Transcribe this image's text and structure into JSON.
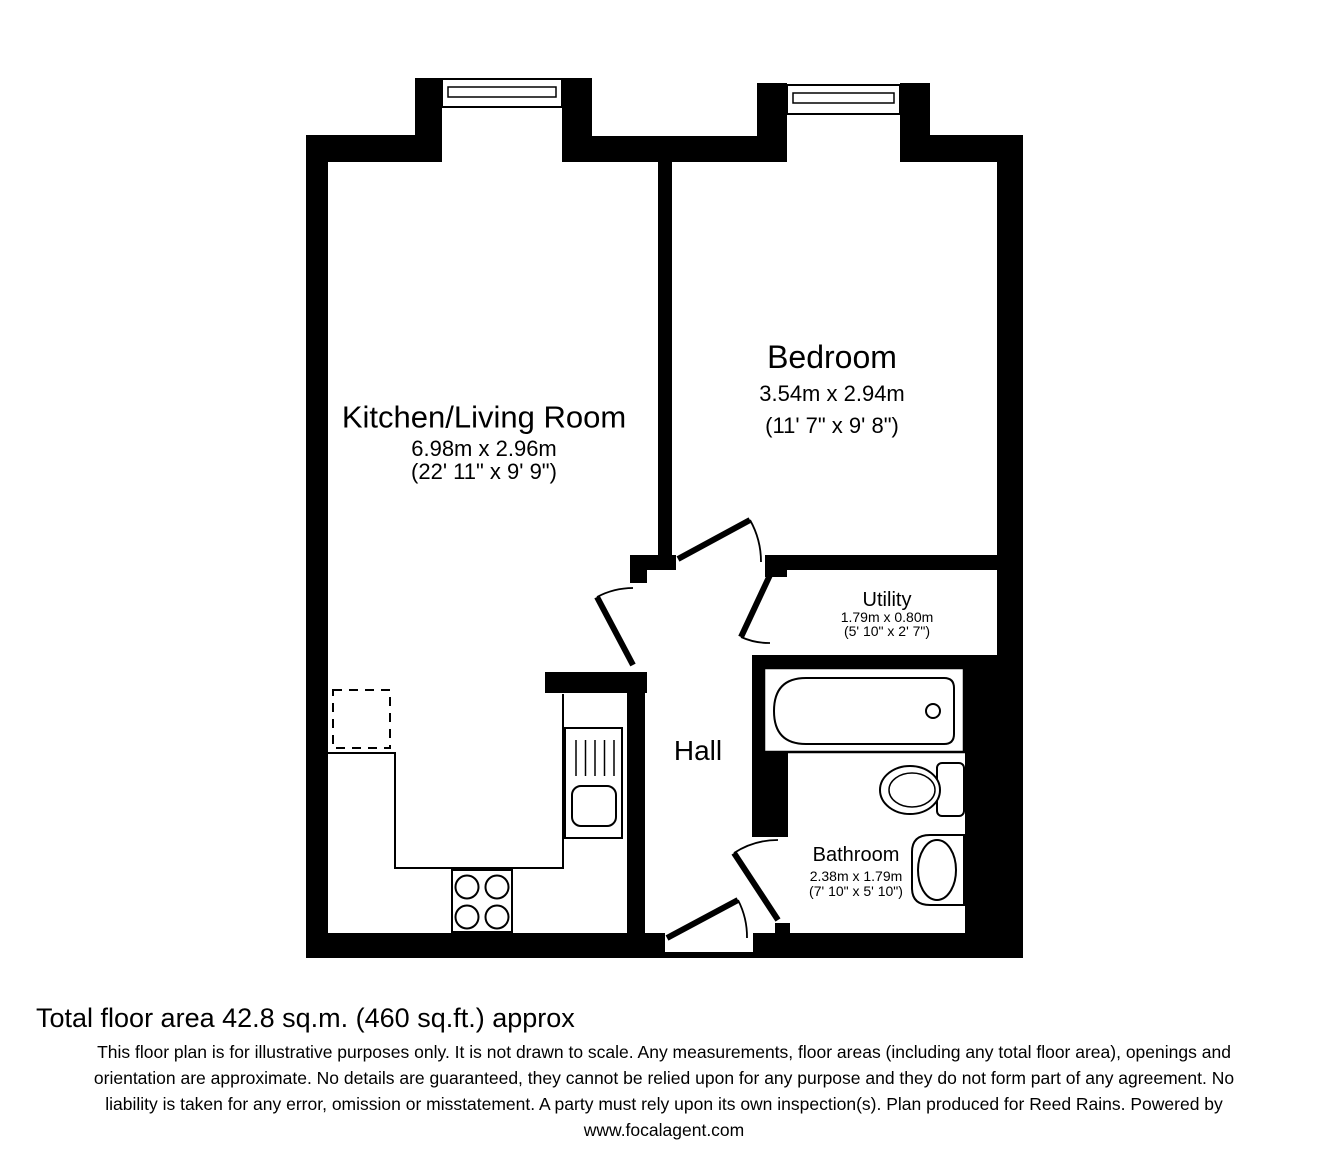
{
  "floorplan": {
    "rooms": {
      "kitchen_living": {
        "name": "Kitchen/Living Room",
        "metric": "6.98m x 2.96m",
        "imperial": "(22' 11\" x 9' 9\")"
      },
      "bedroom": {
        "name": "Bedroom",
        "metric": "3.54m x 2.94m",
        "imperial": "(11' 7\" x 9' 8\")"
      },
      "utility": {
        "name": "Utility",
        "metric": "1.79m x 0.80m",
        "imperial": "(5' 10\" x 2' 7\")"
      },
      "hall": {
        "name": "Hall"
      },
      "bathroom": {
        "name": "Bathroom",
        "metric": "2.38m x 1.79m",
        "imperial": "(7' 10\" x 5' 10\")"
      }
    },
    "fixtures": [
      "window",
      "door-swing",
      "bath",
      "toilet",
      "wash-basin",
      "kitchen-sink",
      "hob",
      "appliance-space",
      "counter"
    ],
    "colors": {
      "wall": "#000000",
      "background": "#ffffff"
    }
  },
  "footer": {
    "total_area": "Total floor area 42.8 sq.m. (460 sq.ft.) approx",
    "disclaimer_lines": [
      "This floor plan is for illustrative purposes only. It is not drawn to scale. Any measurements, floor areas (including any total floor area), openings and",
      "orientation are approximate. No details are guaranteed, they cannot be relied upon for any purpose and they do not form part of any agreement. No",
      "liability is taken for any error, omission or misstatement. A party must rely upon its own inspection(s). Plan produced for Reed Rains. Powered by",
      "www.focalagent.com"
    ]
  }
}
